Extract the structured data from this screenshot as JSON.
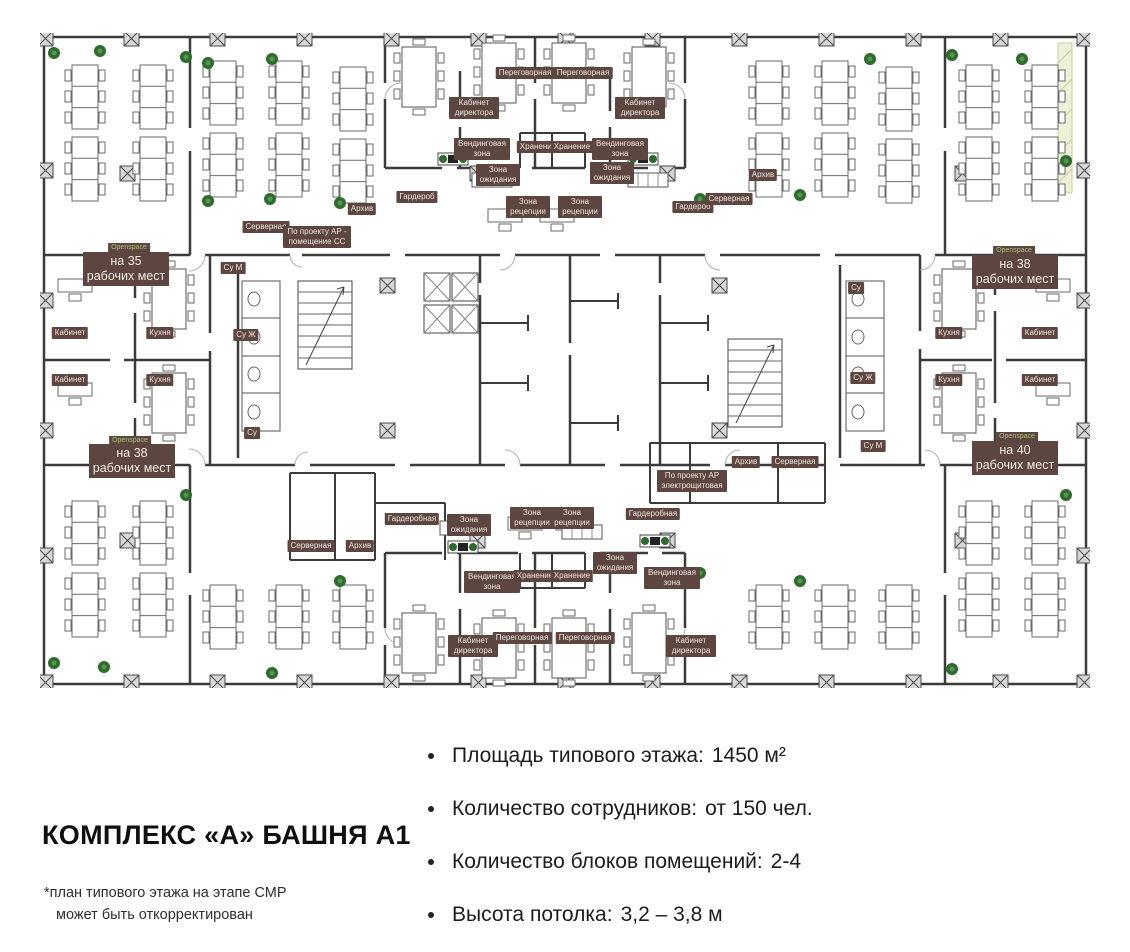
{
  "plan": {
    "openspaces": [
      {
        "tag": "Openspace",
        "text": "на 35 рабочих мест"
      },
      {
        "tag": "Openspace",
        "text": "на 38 рабочих мест"
      },
      {
        "tag": "Openspace",
        "text": "на 38 рабочих мест"
      },
      {
        "tag": "Openspace",
        "text": "на 40 рабочих мест"
      }
    ],
    "labels": [
      {
        "text": "Серверная"
      },
      {
        "text": "По проекту АР - помещение СС"
      },
      {
        "text": "Архив"
      },
      {
        "text": "Гардероб"
      },
      {
        "text": "Вендинговая зона"
      },
      {
        "text": "Кабинет директора"
      },
      {
        "text": "Переговорная"
      },
      {
        "text": "Переговорная"
      },
      {
        "text": "Кабинет директора"
      },
      {
        "text": "Вендинговая зона"
      },
      {
        "text": "Хранение"
      },
      {
        "text": "Хранение"
      },
      {
        "text": "Зона ожидания"
      },
      {
        "text": "Зона ожидания"
      },
      {
        "text": "Зона рецепции"
      },
      {
        "text": "Зона рецепции"
      },
      {
        "text": "Гардероб"
      },
      {
        "text": "Серверная"
      },
      {
        "text": "Архив"
      },
      {
        "text": "Кабинет"
      },
      {
        "text": "Кухня"
      },
      {
        "text": "Кабинет"
      },
      {
        "text": "Кухня"
      },
      {
        "text": "Кухня"
      },
      {
        "text": "Кабинет"
      },
      {
        "text": "Кухня"
      },
      {
        "text": "Кабинет"
      },
      {
        "text": "Су М"
      },
      {
        "text": "Су Ж"
      },
      {
        "text": "Су"
      },
      {
        "text": "Су"
      },
      {
        "text": "Су Ж"
      },
      {
        "text": "Су М"
      },
      {
        "text": "Серверная"
      },
      {
        "text": "Архив"
      },
      {
        "text": "Гардеробная"
      },
      {
        "text": "Зона ожидания"
      },
      {
        "text": "Зона рецепции"
      },
      {
        "text": "Зона рецепции"
      },
      {
        "text": "Гардеробная"
      },
      {
        "text": "По проекту АР электрощитовая"
      },
      {
        "text": "Архив"
      },
      {
        "text": "Серверная"
      },
      {
        "text": "Зона ожидания"
      },
      {
        "text": "Вендинговая зона"
      },
      {
        "text": "Хранение"
      },
      {
        "text": "Хранение"
      },
      {
        "text": "Вендинговая зона"
      },
      {
        "text": "Кабинет директора"
      },
      {
        "text": "Переговорная"
      },
      {
        "text": "Переговорная"
      },
      {
        "text": "Кабинет директора"
      }
    ]
  },
  "info": {
    "title": "КОМПЛЕКС «А» БАШНЯ А1",
    "footnote_line1": "*план типового этажа на этапе СМР",
    "footnote_line2": "может быть откорректирован",
    "bullets": [
      {
        "label": "Площадь типового этажа:",
        "value": "1450 м²"
      },
      {
        "label": "Количество сотрудников:",
        "value": "от 150 чел."
      },
      {
        "label": "Количество блоков помещений:",
        "value": "2-4"
      },
      {
        "label": "Высота потолка:",
        "value": "3,2 – 3,8 м"
      }
    ]
  },
  "colors": {
    "badge_background": "#5d4640",
    "badge_text": "#f2e8e2",
    "openspace_tag_text": "#a9c477",
    "wall": "#3b3b3b",
    "plant_green": "#2e6b2e"
  }
}
